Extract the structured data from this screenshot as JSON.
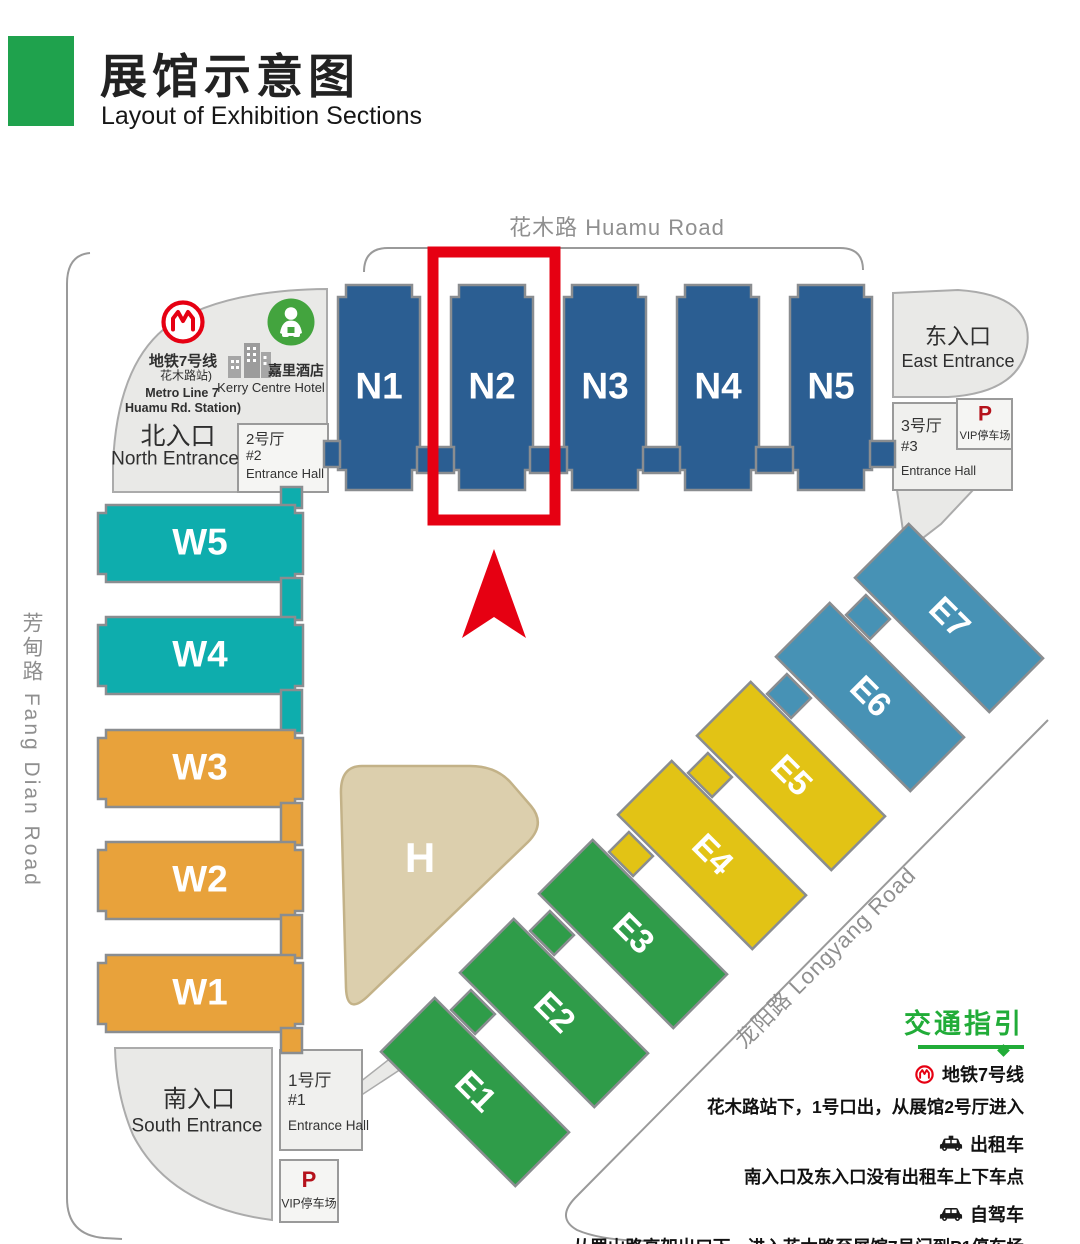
{
  "header": {
    "title": "展馆示意图",
    "subtitle": "Layout of Exhibition Sections"
  },
  "roads": {
    "huamu": "花木路 Huamu Road",
    "fangdian": "芳甸路 Fang Dian Road",
    "longyang": "龙阳路  Longyang Road"
  },
  "halls": {
    "n1": "N1",
    "n2": "N2",
    "n3": "N3",
    "n4": "N4",
    "n5": "N5",
    "w1": "W1",
    "w2": "W2",
    "w3": "W3",
    "w4": "W4",
    "w5": "W5",
    "e1": "E1",
    "e2": "E2",
    "e3": "E3",
    "e4": "E4",
    "e5": "E5",
    "e6": "E6",
    "e7": "E7",
    "h": "H"
  },
  "entrances": {
    "north_cn": "北入口",
    "north_en": "North Entrance",
    "east_cn": "东入口",
    "east_en": "East Entrance",
    "south_cn": "南入口",
    "south_en": "South Entrance"
  },
  "entrance_halls": {
    "hall1_cn": "1号厅",
    "hall1_num": "#1",
    "hall1_en": "Entrance Hall",
    "hall2_cn": "2号厅",
    "hall2_num": "#2",
    "hall2_en": "Entrance Hall",
    "hall3_cn": "3号厅",
    "hall3_num": "#3",
    "hall3_en": "Entrance Hall"
  },
  "parking": {
    "p": "P",
    "vip": "VIP停车场"
  },
  "landmarks": {
    "metro_line_cn": "地铁7号线",
    "metro_station_cn": "花木路站)",
    "metro_line_en": "Metro Line 7",
    "metro_station_en": "Huamu Rd. Station)",
    "hotel_cn": "嘉里酒店",
    "hotel_en": "Kerry Centre Hotel"
  },
  "guide": {
    "title": "交通指引",
    "metro_label": "地铁7号线",
    "metro_desc": "花木路站下，1号口出，从展馆2号厅进入",
    "taxi_label": "出租车",
    "taxi_desc": "南入口及东入口没有出租车上下车点",
    "car_label": "自驾车",
    "car_desc": "从罗山路高架出口下，进入花木路至展馆7号门到P1停车场"
  },
  "colors": {
    "accent_green": "#1fa24d",
    "guide_green": "#21ac38",
    "hall_blue": "#2b5e92",
    "hall_teal": "#0eadad",
    "hall_orange": "#e8a23b",
    "hall_green": "#2f9c49",
    "hall_yellow": "#e2c315",
    "hall_steel": "#4792b5",
    "h_tan": "#dccfad",
    "highlight_red": "#e60012"
  }
}
